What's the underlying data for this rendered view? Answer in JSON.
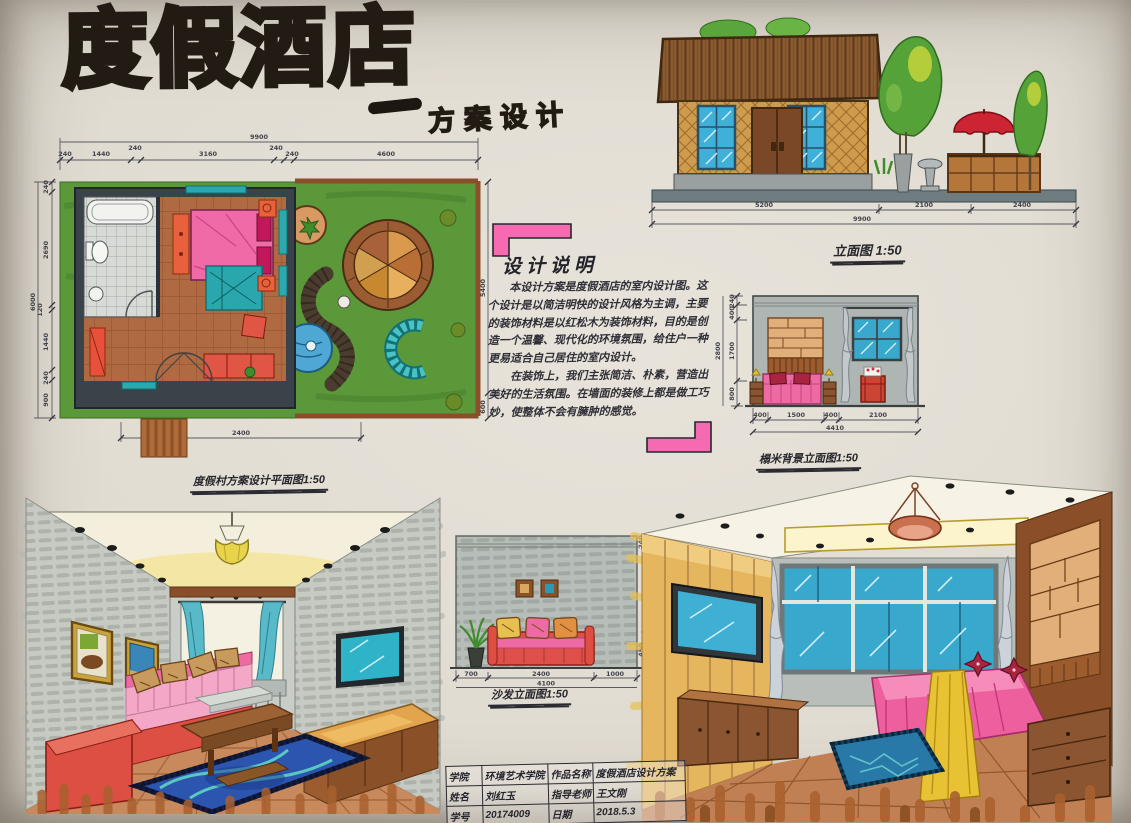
{
  "board": {
    "title": "度假酒店",
    "subtitle_dash": "—",
    "subtitle": "方案设计"
  },
  "floor_plan": {
    "caption": "度假村方案设计平面图1:50",
    "overall_width": "9900",
    "dims_top": [
      "240",
      "1440",
      "240",
      "3160",
      "240",
      "240",
      "4600"
    ],
    "overall_height": "6000",
    "dims_left": [
      "240",
      "2690",
      "120",
      "1440",
      "240",
      "900"
    ],
    "dims_right": [
      "5400",
      "600"
    ],
    "dim_bottom": "2400"
  },
  "building_elevation": {
    "caption": "立面图 1:50",
    "dims": [
      "5200",
      "2100",
      "2400"
    ],
    "overall": "9900"
  },
  "bed_elevation": {
    "caption": "榻米背景立面图1:50",
    "dims_bottom": [
      "400",
      "1500",
      "400",
      "2100"
    ],
    "overall_bottom": "4410",
    "dims_left": [
      "240",
      "400",
      "1700",
      "800"
    ],
    "overall_left": "2800"
  },
  "sofa_elevation": {
    "caption": "沙发立面图1:50",
    "dims_bottom": [
      "700",
      "2400",
      "1000"
    ],
    "overall_bottom": "4100",
    "dims_right": [
      "240",
      "450"
    ]
  },
  "design_note": {
    "heading": "设计说明",
    "para1": "本设计方案是度假酒店的室内设计图。这个设计是以简洁明快的设计风格为主调，主要的装饰材料是以红松木为装饰材料，目的是创造一个温馨、现代化的环境氛围，给住户一种更易适合自己居住的室内设计。",
    "para2": "在装饰上，我们主张简洁、朴素，营造出美好的生活氛围。在墙面的装修上都是做工巧妙，使整体不会有臃肿的感觉。"
  },
  "title_block": {
    "rows": [
      {
        "label_a": "学院",
        "value_a": "环境艺术学院",
        "label_b": "作品名称",
        "value_b": "度假酒店设计方案"
      },
      {
        "label_a": "姓名",
        "value_a": "刘红玉",
        "label_b": "指导老师",
        "value_b": "王文刚"
      },
      {
        "label_a": "学号",
        "value_a": "20174009",
        "label_b": "日期",
        "value_b": "2018.5.3"
      }
    ]
  }
}
